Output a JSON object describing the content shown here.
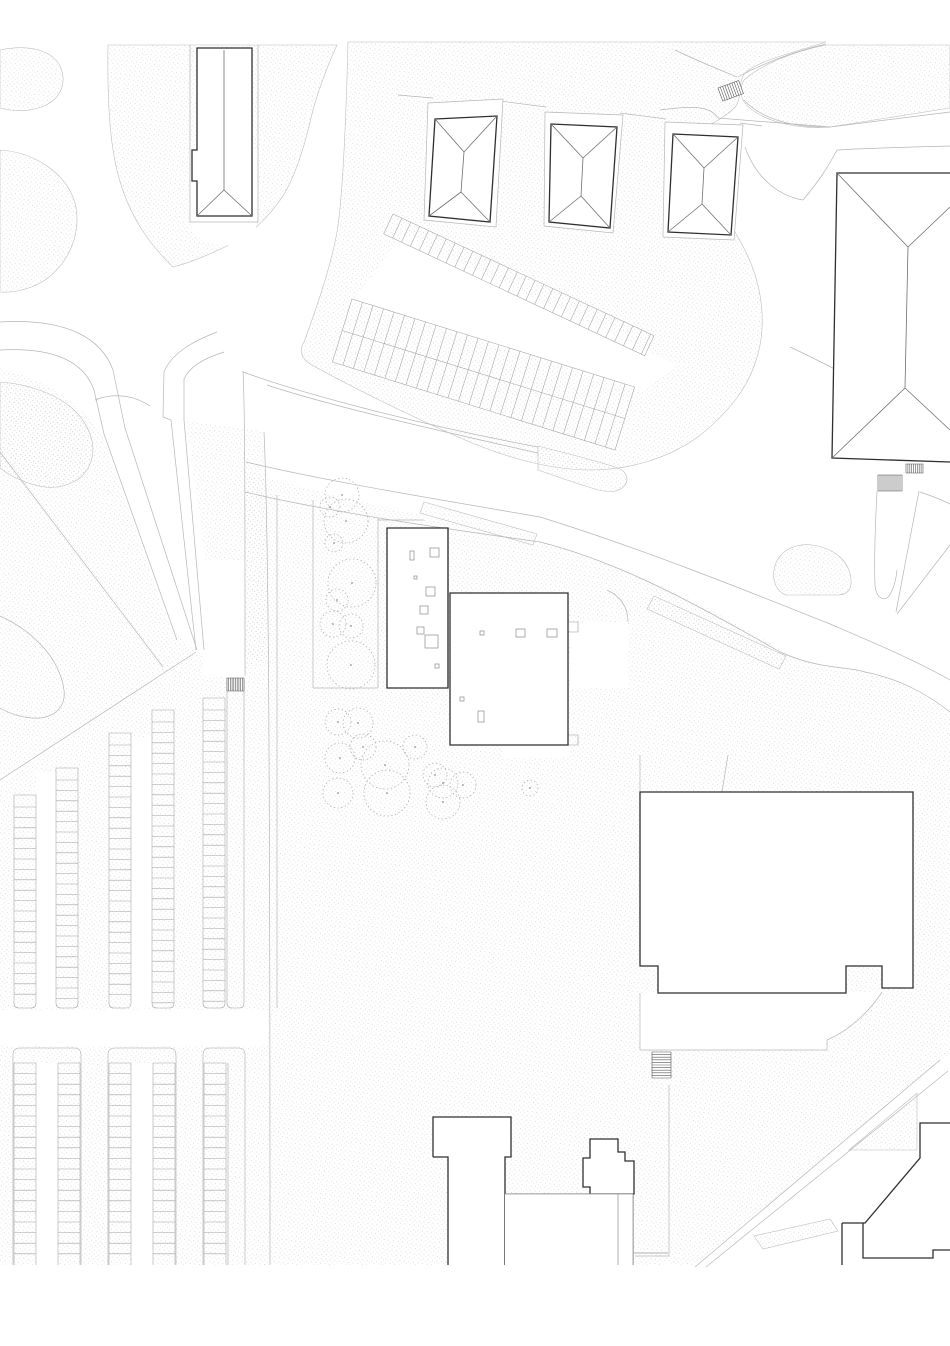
{
  "meta": {
    "title": "architectural-site-plan",
    "description": "Black and white site plan: hipped-roof houses, flat-roof cultural building with skylights, large halls, parking rows, tree circles, footpaths on stippled ground",
    "visible_text": []
  },
  "canvas": {
    "width": 950,
    "height": 1346,
    "background": "#ffffff",
    "drawing_bottom": 1265
  },
  "colors": {
    "white": "#ffffff",
    "dark": "#2f2f2f",
    "roof": "#6f6f6f",
    "light": "#b6b6b6",
    "stall": "#a2a2a2",
    "tree": "#b0b0b0",
    "hatch": "#555555",
    "inner": "#999999",
    "dot": "#c6c6c6"
  },
  "patches": [
    {
      "name": "veg-corner-northwest",
      "d": "M0,50 C28,44 52,50 60,66 C68,84 60,102 38,108 C22,113 8,110 0,108 Z",
      "s": 1
    },
    {
      "name": "veg-around-slab-building",
      "d": "M108,45 C107,110 111,150 119,178 C129,214 147,242 173,267 C193,262 215,252 233,243 C253,233 270,215 283,196 C297,173 306,140 311,118 C317,92 330,60 337,45 Z",
      "s": 1
    },
    {
      "name": "ground-top-center",
      "d": "M348,42 L826,42 C796,52 758,60 744,74 C738,84 742,96 736,106 C726,118 708,125 698,131 C690,146 694,168 706,188 C722,210 741,238 752,266 C762,292 766,324 758,354 C749,388 727,414 699,436 C668,459 628,470 590,470 C548,470 500,456 456,436 C402,412 350,386 310,364 C301,358 299,350 304,342 C315,312 330,270 337,232 C343,196 346,120 348,42 Z",
      "s": 1
    },
    {
      "name": "ground-top-right",
      "d": "M744,80 C762,64 792,52 826,45 L950,45 L950,108 L830,127 C792,130 757,119 744,102 C740,95 740,87 744,80 Z",
      "s": 1
    },
    {
      "name": "lawn-round-west",
      "d": "M0,150 C33,152 66,172 75,203 C82,232 70,264 42,282 C28,290 12,293 0,292 Z",
      "s": 1
    },
    {
      "name": "lawn-west-large",
      "d": "M0,368 C55,382 90,412 103,438 C125,500 152,580 172,630 L196,652 L0,782 Z",
      "s": 0
    },
    {
      "name": "lawn-island-west",
      "d": "M0,382 C28,384 58,394 75,411 C91,427 97,448 90,464 C83,481 64,489 45,487 C28,485 10,476 0,468 Z",
      "s": 1
    },
    {
      "name": "median-wedge-paths",
      "d": "M186,420 L262,432 C267,470 269,560 269,658 L245,670 L222,660 C210,600 198,500 186,420 Z",
      "s": 0
    },
    {
      "name": "road-median-sliver-1",
      "d": "M538,446 C570,454 600,462 618,468 C628,472 630,482 622,488 C616,493 605,492 595,489 C575,483 555,476 538,470 Z",
      "s": 1
    },
    {
      "name": "road-median-sliver-2",
      "d": "M424,502 L537,534 L533,545 L420,513 Z",
      "s": 1
    },
    {
      "name": "road-median-strip-east",
      "d": "M654,596 L786,656 L779,669 L647,609 Z",
      "s": 1
    },
    {
      "name": "landscape-berm",
      "d": "M774,570 C777,552 793,543 812,545 C835,548 850,562 851,580 C852,589 847,595 838,595 L786,595 C777,592 772,581 774,570 Z",
      "s": 1
    },
    {
      "name": "ground-main-south",
      "d": "M245,472 C340,498 450,522 540,542 C630,565 720,612 790,655 C830,672 848,668 865,672 C905,680 932,698 950,714 L950,1053 L695,1265 L0,1265 L0,784 L196,652 L226,658 L245,677 Z",
      "s": 0
    },
    {
      "name": "road-island-triangle",
      "d": "M849,1150 L917,1150 L917,1093 Z",
      "s": 1
    },
    {
      "name": "road-island-strip",
      "d": "M754,1236 L830,1219 L838,1231 L763,1249 Z",
      "s": 1
    }
  ],
  "whites": [
    {
      "name": "path-around-slab-building",
      "d": "M190,150 L190,215 Q190,243 224,246 Q258,243 258,215 L258,150 Z"
    },
    {
      "name": "aisle-between-diagonal-rows",
      "d": "M402,236 L676,364 L644,392 L352,302 Z"
    },
    {
      "name": "parking-cross-road",
      "d": "M0,1010 L268,1010 L268,1046 L0,1046 Z"
    },
    {
      "name": "stair-path-channel",
      "d": "M203,560 L245,560 L245,677 L203,677 Z"
    },
    {
      "name": "aisle-upper-1",
      "d": "M36,772 L56,772 L56,1008 L36,1008 Z"
    },
    {
      "name": "aisle-upper-2",
      "d": "M131,737 L152,737 L152,1008 L131,1008 Z"
    },
    {
      "name": "aisle-lower-1",
      "d": "M36,1063 L58,1063 L58,1265 L36,1265 Z"
    },
    {
      "name": "aisle-lower-2",
      "d": "M131,1063 L153,1063 L153,1265 L131,1265 Z"
    },
    {
      "name": "hall-apron-terrace",
      "d": "M640,993 L640,1050 L827,1050 L827,1040 C846,1032 868,1014 882,992 Z"
    },
    {
      "name": "funnel-path",
      "d": "M877,491 L919,491 L896,612 L884,599 L875,585 Z"
    },
    {
      "name": "terrace-east-of-center",
      "d": "M570,622 L628,622 L628,688 L570,688 Z"
    },
    {
      "name": "terrace-below-center",
      "d": "M503,745 L570,745 L570,758 L503,758 Z"
    }
  ],
  "strokes": [
    {
      "name": "path-west-outer",
      "d": "M0,322 C70,318 102,340 113,370 L125,428 L197,650",
      "c": "light",
      "w": 0.7
    },
    {
      "name": "path-west-inner",
      "d": "M0,350 C55,347 84,362 94,390 L104,434 L177,640",
      "c": "light",
      "w": 0.7
    },
    {
      "name": "hairpin-outer",
      "d": "M217,332 C196,340 172,352 164,372 L163,417 L171,420 L196,650",
      "c": "light",
      "w": 0.7
    },
    {
      "name": "hairpin-inner",
      "d": "M224,352 C205,358 189,367 184,379 L184,420 L204,650",
      "c": "light",
      "w": 0.7
    },
    {
      "name": "channel-east-edge",
      "d": "M243,371 C245,410 245,500 245,676",
      "c": "light",
      "w": 0.7
    },
    {
      "name": "upper-path-north-edge",
      "d": "M243,372 C300,393 420,425 538,447",
      "c": "light",
      "w": 0.7
    },
    {
      "name": "upper-path-south-edge",
      "d": "M267,385 C330,406 440,431 538,453",
      "c": "light",
      "w": 0.7
    },
    {
      "name": "main-road-north-edge",
      "d": "M246,462 C320,480 430,498 540,517 C640,548 745,590 830,624 C872,642 915,660 950,680",
      "c": "light",
      "w": 0.7
    },
    {
      "name": "main-road-south-edge",
      "d": "M245,492 C330,512 440,528 540,542 C620,562 700,606 780,652 C820,670 848,666 865,672 C905,680 932,698 950,712",
      "c": "light",
      "w": 0.7
    },
    {
      "name": "east-road-edge-a",
      "d": "M950,545 L897,614",
      "c": "light",
      "w": 0.7
    },
    {
      "name": "east-road-edge-b",
      "d": "M920,492 C932,496 942,500 950,504",
      "c": "light",
      "w": 0.7
    },
    {
      "name": "sidewalk-x270",
      "d": "M264,432 C268,520 270,700 270,1265",
      "c": "light",
      "w": 0.7
    },
    {
      "name": "sidewalk-x277",
      "d": "M277,495 L277,1008",
      "c": "light",
      "w": 0.7
    },
    {
      "name": "lawn-diagonal-fence",
      "d": "M0,452 L163,667",
      "c": "light",
      "w": 0.7
    },
    {
      "name": "parking-top-boundary",
      "d": "M0,780 L196,652",
      "c": "light",
      "w": 0.7
    },
    {
      "name": "lawn-corner-curve",
      "d": "M0,616 C35,632 60,660 64,690 C66,706 56,716 40,718 C25,719 10,714 0,708",
      "c": "light",
      "w": 0.7
    },
    {
      "name": "island-tail",
      "d": "M95,400 C115,392 135,396 150,406",
      "c": "light",
      "w": 0.7
    },
    {
      "name": "junction-curve-a",
      "d": "M675,50 C700,62 720,70 737,77",
      "c": "light",
      "w": 0.7
    },
    {
      "name": "junction-curve-b",
      "d": "M738,77 C762,64 792,52 826,44",
      "c": "light",
      "w": 0.7
    },
    {
      "name": "junction-curve-c",
      "d": "M660,110 C690,106 710,105 718,118",
      "c": "light",
      "w": 0.7
    },
    {
      "name": "junction-boundary",
      "d": "M718,118 L830,127 L950,112",
      "c": "light",
      "w": 0.7
    },
    {
      "name": "junction-curve-d",
      "d": "M744,100 C760,118 792,128 830,127",
      "c": "light",
      "w": 0.7
    },
    {
      "name": "road-south-curve-1",
      "d": "M745,147 C755,175 775,195 803,200",
      "c": "light",
      "w": 0.7
    },
    {
      "name": "road-south-curve-2",
      "d": "M803,200 C820,180 829,165 837,150",
      "c": "light",
      "w": 0.7
    },
    {
      "name": "road-north-of-hall",
      "d": "M837,150 C870,148 910,147 950,146",
      "c": "light",
      "w": 0.7
    },
    {
      "name": "road-east-diagonal",
      "d": "M790,347 C830,365 885,397 950,427",
      "c": "light",
      "w": 0.7
    },
    {
      "name": "house-plot-step-1",
      "d": "M398,95 L433,98",
      "c": "light",
      "w": 0.7
    },
    {
      "name": "house-plot-step-2",
      "d": "M500,101 L546,107",
      "c": "light",
      "w": 0.7
    },
    {
      "name": "house-plot-step-3",
      "d": "M620,113 L666,119",
      "c": "light",
      "w": 0.7
    },
    {
      "name": "house-plot-step-4",
      "d": "M740,123 L762,126",
      "c": "light",
      "w": 0.7
    },
    {
      "name": "hall-plot-line-a",
      "d": "M640,755 L640,792",
      "c": "light",
      "w": 0.7
    },
    {
      "name": "hall-plot-line-b",
      "d": "M728,755 L722,792",
      "c": "light",
      "w": 0.7
    },
    {
      "name": "south-plot-line-v",
      "d": "M669,1085 L669,1256",
      "c": "light",
      "w": 0.7
    },
    {
      "name": "south-plot-line-h",
      "d": "M635,1256 L669,1256",
      "c": "light",
      "w": 0.7
    },
    {
      "name": "southeast-road-edge-a",
      "d": "M940,1060 L695,1267",
      "c": "light",
      "w": 0.7
    },
    {
      "name": "southeast-road-edge-b",
      "d": "M948,1071 L706,1267",
      "c": "light",
      "w": 0.7
    },
    {
      "name": "apron-edge-w",
      "d": "M640,993 L640,1050 L827,1050 L827,1040",
      "c": "light",
      "w": 0.7
    },
    {
      "name": "apron-curve",
      "d": "M882,992 C868,1014 846,1032 827,1040",
      "c": "light",
      "w": 0.7
    },
    {
      "name": "funnel-left-edge",
      "d": "M877,491 C875,530 874,560 875,585 C876,598 884,602 889,596 C893,590 896,580 897,570",
      "c": "light",
      "w": 0.7
    },
    {
      "name": "funnel-right-edge",
      "d": "M919,491 L896,612",
      "c": "light",
      "w": 0.7
    },
    {
      "name": "terrace-arc",
      "d": "M607,590 C622,597 628,608 628,622",
      "c": "light",
      "w": 0.7
    },
    {
      "name": "tree-lawn-boundary",
      "d": "M313,500 L313,688 M313,688 L378,688 M378,518 L378,688 M378,520 L424,520",
      "c": "light",
      "w": 0.7
    },
    {
      "name": "center-internal-band",
      "d": "M450,655 L568,655 M450,678 L568,678 M468,655 L468,678 M481,655 L481,678",
      "c": "inner",
      "w": 0.6
    },
    {
      "name": "hall-internal-line",
      "d": "M641,889 L912,889",
      "c": "inner",
      "w": 0.6
    },
    {
      "name": "south-structure-lines",
      "d": "M505,1194 L633,1194 M618,1194 L618,1265 M633,1194 L633,1265",
      "c": "dark",
      "w": 1.1
    },
    {
      "name": "t-building-notch",
      "d": "M504,1265 L504,1248 L518,1248 L518,1256",
      "c": "dark",
      "w": 1.1
    },
    {
      "name": "terrace-inner-rects",
      "d": "M506,661 L567,661 L567,677 L506,677 Z M509,664 L564,664 L564,674 L509,674 Z M568,622 L578,622 L578,632 L568,632 M568,735 L578,735 L578,745 L568,745",
      "c": "inner",
      "w": 0.6
    },
    {
      "name": "slab-building-plot",
      "d": "M190,45 L190,222 L258,222 L258,45",
      "c": "light",
      "w": 0.7
    }
  ],
  "footprints": [
    {
      "name": "house-1-footprint",
      "d": "M428,103 L503,99 L496,227 L424,220 Z"
    },
    {
      "name": "house-2-footprint",
      "d": "M545,112 L623,115 L613,233 L544,226 Z"
    },
    {
      "name": "house-3-footprint",
      "d": "M665,122 L743,125 L734,240 L663,237 Z"
    }
  ],
  "buildings": [
    {
      "name": "slab-building-northwest",
      "fill": "M197,48 L252,48 L252,216 L197,216 L197,181 L192,181 L192,150 L197,150 Z",
      "outline": "M197,48 L197,150 L192,150 L192,181 L197,181 L197,216 L252,216 L252,48 Z",
      "roof": "M224,50 L224,190 M224,190 L197,216 M224,190 L252,216"
    },
    {
      "name": "house-1",
      "fill": "M435,119 L497,116 L490,222 L429,216 Z",
      "outline": "M435,119 L497,116 L490,222 L429,216 Z",
      "roof": "M435,119 L464,152 M497,116 L464,152 M464,152 L461,192 M461,192 L429,216 M461,192 L490,222"
    },
    {
      "name": "house-2",
      "fill": "M551,124 L617,127 L610,228 L549,222 Z",
      "outline": "M551,124 L617,127 L610,228 L549,222 Z",
      "roof": "M551,124 L583,158 M617,127 L583,158 M583,158 L581,196 M581,196 L549,222 M581,196 L610,228"
    },
    {
      "name": "house-3",
      "fill": "M673,134 L738,137 L731,235 L668,232 Z",
      "outline": "M673,134 L738,137 L731,235 L668,232 Z",
      "roof": "M673,134 L704,168 M738,137 L704,168 M704,168 L702,204 M702,204 L668,232 M702,204 L731,235"
    },
    {
      "name": "hall-northeast",
      "fill": "M837,173 L950,173 L950,462 L832,458 Z",
      "outline": "M950,173 L837,173 L832,458 L950,462",
      "roof": "M837,173 L908,247 M908,247 L905,388 M905,388 L832,458 M908,247 L950,207 M905,388 L950,430"
    },
    {
      "name": "center-building-east-wing",
      "fill": "M450,593 L568,593 L568,745 L450,745 Z",
      "outline": "M450,593 L568,593 L568,745 L450,745 Z",
      "roof": ""
    },
    {
      "name": "center-building-west-wing",
      "fill": "M387,528 L448,528 L448,688 L387,688 Z",
      "outline": "M387,528 L448,528 L448,688 L387,688 Z",
      "roof": ""
    },
    {
      "name": "hall-east",
      "fill": "M640,792 L913,792 L913,988 L882,988 L882,966 L846,966 L846,993 L658,993 L658,966 L640,966 Z",
      "outline": "M640,792 L913,792 L913,988 L882,988 L882,966 L846,966 L846,993 L658,993 L658,966 L640,966 Z",
      "roof": ""
    },
    {
      "name": "t-building-south",
      "fill": "M433,1117 L511,1117 L511,1157 L505,1157 L505,1265 L448,1265 L448,1157 L433,1157 Z",
      "outline": "M433,1157 L433,1117 L511,1117 L511,1157 L505,1157 L505,1265 M448,1265 L448,1157 L433,1157",
      "roof": ""
    },
    {
      "name": "stepped-building-south",
      "fill": "M590,1139 L618,1139 L618,1152 L625,1152 L625,1161 L634,1161 L634,1194 L590,1194 L590,1187 L583,1187 L583,1158 L590,1158 Z",
      "outline": "M590,1139 L618,1139 L618,1152 L625,1152 L625,1161 L634,1161 L634,1194 L590,1194 L590,1187 L583,1187 L583,1158 L590,1158 Z",
      "roof": ""
    },
    {
      "name": "building-southeast-corner",
      "fill": "M920,1123 L950,1123 L950,1250 L933,1250 L933,1258 L863,1258 L863,1223 L865,1223 L920,1158 Z",
      "outline": "M950,1123 L920,1123 L920,1158 L865,1223 L863,1223 L863,1258 L933,1258 L933,1250 L950,1250 M842,1223 L863,1223 M842,1223 L842,1265",
      "roof": ""
    }
  ],
  "skylights": [
    [
      410,
      551,
      4,
      9
    ],
    [
      430,
      548,
      9,
      9
    ],
    [
      414,
      576,
      3,
      3
    ],
    [
      426,
      587,
      9,
      9
    ],
    [
      420,
      606,
      8,
      8
    ],
    [
      417,
      627,
      7,
      7
    ],
    [
      425,
      635,
      13,
      13
    ],
    [
      435,
      664,
      4,
      4
    ],
    [
      480,
      631,
      4,
      4
    ],
    [
      516,
      629,
      9,
      8
    ],
    [
      547,
      629,
      10,
      8
    ],
    [
      460,
      697,
      4,
      4
    ],
    [
      478,
      711,
      6,
      11
    ]
  ],
  "parking_vertical_upper": {
    "bottom": 1008,
    "step": 10.4,
    "strips": [
      {
        "name": "stall-strip",
        "x1": 14,
        "x2": 36,
        "top": 795,
        "stalls": true
      },
      {
        "name": "stall-strip",
        "x1": 56,
        "x2": 78,
        "top": 768,
        "stalls": true
      },
      {
        "name": "stall-strip",
        "x1": 109,
        "x2": 131,
        "top": 733,
        "stalls": true
      },
      {
        "name": "stall-strip",
        "x1": 152,
        "x2": 174,
        "top": 710,
        "stalls": true
      },
      {
        "name": "stall-strip",
        "x1": 203,
        "x2": 225,
        "top": 698,
        "stalls": true
      },
      {
        "name": "walkway-strip",
        "x1": 227,
        "x2": 244,
        "top": 680,
        "stalls": false
      }
    ]
  },
  "parking_blocks_lower": {
    "top": 1048,
    "bottom": 1265,
    "step": 10.6,
    "stall_top": 1063,
    "blocks": [
      {
        "name": "parking-block",
        "o": [
          13,
          81
        ],
        "cols": [
          [
            14,
            36
          ],
          [
            58,
            80
          ]
        ]
      },
      {
        "name": "parking-block",
        "o": [
          108,
          176
        ],
        "cols": [
          [
            109,
            131
          ],
          [
            153,
            175
          ]
        ]
      },
      {
        "name": "parking-block-with-walkway",
        "o": [
          203,
          245
        ],
        "cols": [
          [
            204,
            226
          ]
        ],
        "extra_edge": 228
      }
    ]
  },
  "parking_diagonal": [
    {
      "name": "diagonal-row-single",
      "x": 393,
      "y": 214,
      "ang": 25,
      "len": 288,
      "depth": 22,
      "step": 9.8,
      "mid": 0
    },
    {
      "name": "diagonal-row-double",
      "x": 352,
      "y": 299,
      "ang": 17.3,
      "len": 296,
      "depth": 66,
      "step": 11,
      "mid": 33
    }
  ],
  "stairs": [
    {
      "name": "stairs-junction",
      "x": 718,
      "y": 88,
      "w": 22,
      "h": 14,
      "n": 8,
      "dir": "v",
      "rot": -20
    },
    {
      "name": "stairs-hall-ne-a",
      "x": 906,
      "y": 464,
      "w": 17,
      "h": 9,
      "n": 8,
      "dir": "v",
      "rot": 0
    },
    {
      "name": "stairs-hall-ne-b",
      "x": 878,
      "y": 475,
      "w": 24,
      "h": 16,
      "n": 11,
      "dir": "v",
      "rot": 0
    },
    {
      "name": "stairs-walkway",
      "x": 227,
      "y": 678,
      "w": 17,
      "h": 13,
      "n": 9,
      "dir": "v",
      "rot": 0
    },
    {
      "name": "stairs-apron",
      "x": 652,
      "y": 1052,
      "w": 19,
      "h": 26,
      "n": 9,
      "dir": "h",
      "rot": 0
    }
  ],
  "trees": [
    [
      342,
      495,
      17
    ],
    [
      330,
      507,
      10
    ],
    [
      346,
      521,
      22
    ],
    [
      334,
      543,
      9
    ],
    [
      352,
      583,
      24
    ],
    [
      337,
      600,
      11
    ],
    [
      333,
      624,
      13
    ],
    [
      351,
      626,
      12
    ],
    [
      351,
      665,
      24
    ],
    [
      338,
      722,
      13
    ],
    [
      358,
      723,
      15
    ],
    [
      363,
      747,
      13
    ],
    [
      340,
      758,
      15
    ],
    [
      385,
      765,
      24
    ],
    [
      415,
      747,
      12
    ],
    [
      338,
      793,
      15
    ],
    [
      387,
      793,
      23
    ],
    [
      435,
      775,
      12
    ],
    [
      443,
      783,
      15
    ],
    [
      463,
      785,
      13
    ],
    [
      443,
      802,
      17
    ],
    [
      530,
      788,
      8
    ]
  ]
}
